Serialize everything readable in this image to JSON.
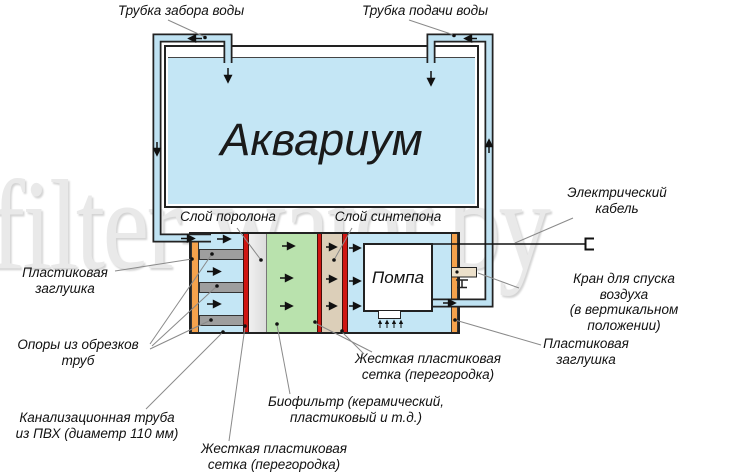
{
  "watermark": "filter-water.by",
  "aquarium": {
    "label": "Аквариум"
  },
  "pump": {
    "label": "Помпа"
  },
  "callouts": {
    "intake_tube": "Трубка забора воды",
    "supply_tube": "Трубка подачи воды",
    "foam_layer": "Слой поролона",
    "synthetic_layer": "Слой синтепона",
    "electric_cable": "Электрический\nкабель",
    "plastic_plug_left": "Пластиковая\nзаглушка",
    "pipe_supports": "Опоры из обрезков\nтруб",
    "sewer_pipe": "Канализационная труба\nиз ПВХ (диаметр 110 мм)",
    "mesh_bottom": "Жесткая пластиковая\nсетка (перегородка)",
    "biofilter": "Биофильтр (керамический,\nпластиковый и т.д.)",
    "mesh_right": "Жесткая пластиковая\nсетка (перегородка)",
    "plastic_plug_right": "Пластиковая\nзаглушка",
    "air_valve": "Кран для спуска воздуха\n(в вертикальном положении)"
  },
  "colors": {
    "water": "#c4e6f5",
    "pipe": "#bfe2f2",
    "plug": "#f5a24c",
    "mesh": "#cf1612",
    "bio": "#b9e2ad",
    "synt": "#dccfb9",
    "support": "#9e9e9e",
    "outline": "#222222"
  }
}
